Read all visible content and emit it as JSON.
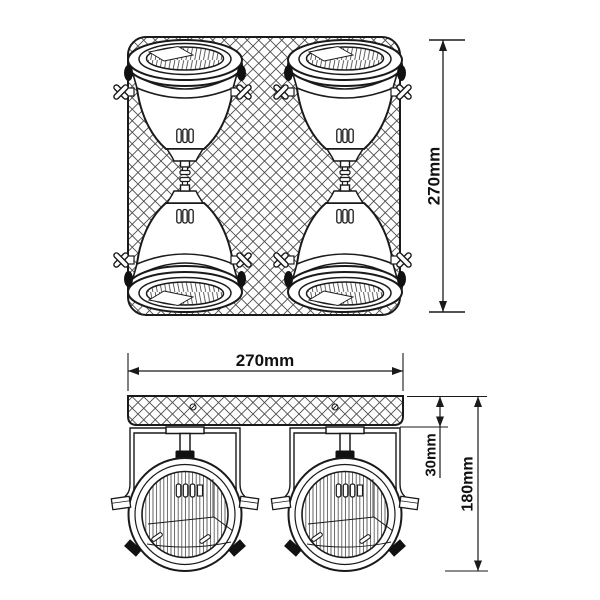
{
  "page": {
    "background_color": "#ffffff",
    "line_color": "#1a1a1a",
    "description": "Dimension line drawing of a four-head spotlight ceiling fixture with cross-hatched square canopy, top view and front view"
  },
  "top_view": {
    "height_dimension": "270mm"
  },
  "front_view": {
    "width_dimension": "270mm",
    "canopy_offset_dimension": "30mm",
    "height_dimension": "180mm"
  }
}
